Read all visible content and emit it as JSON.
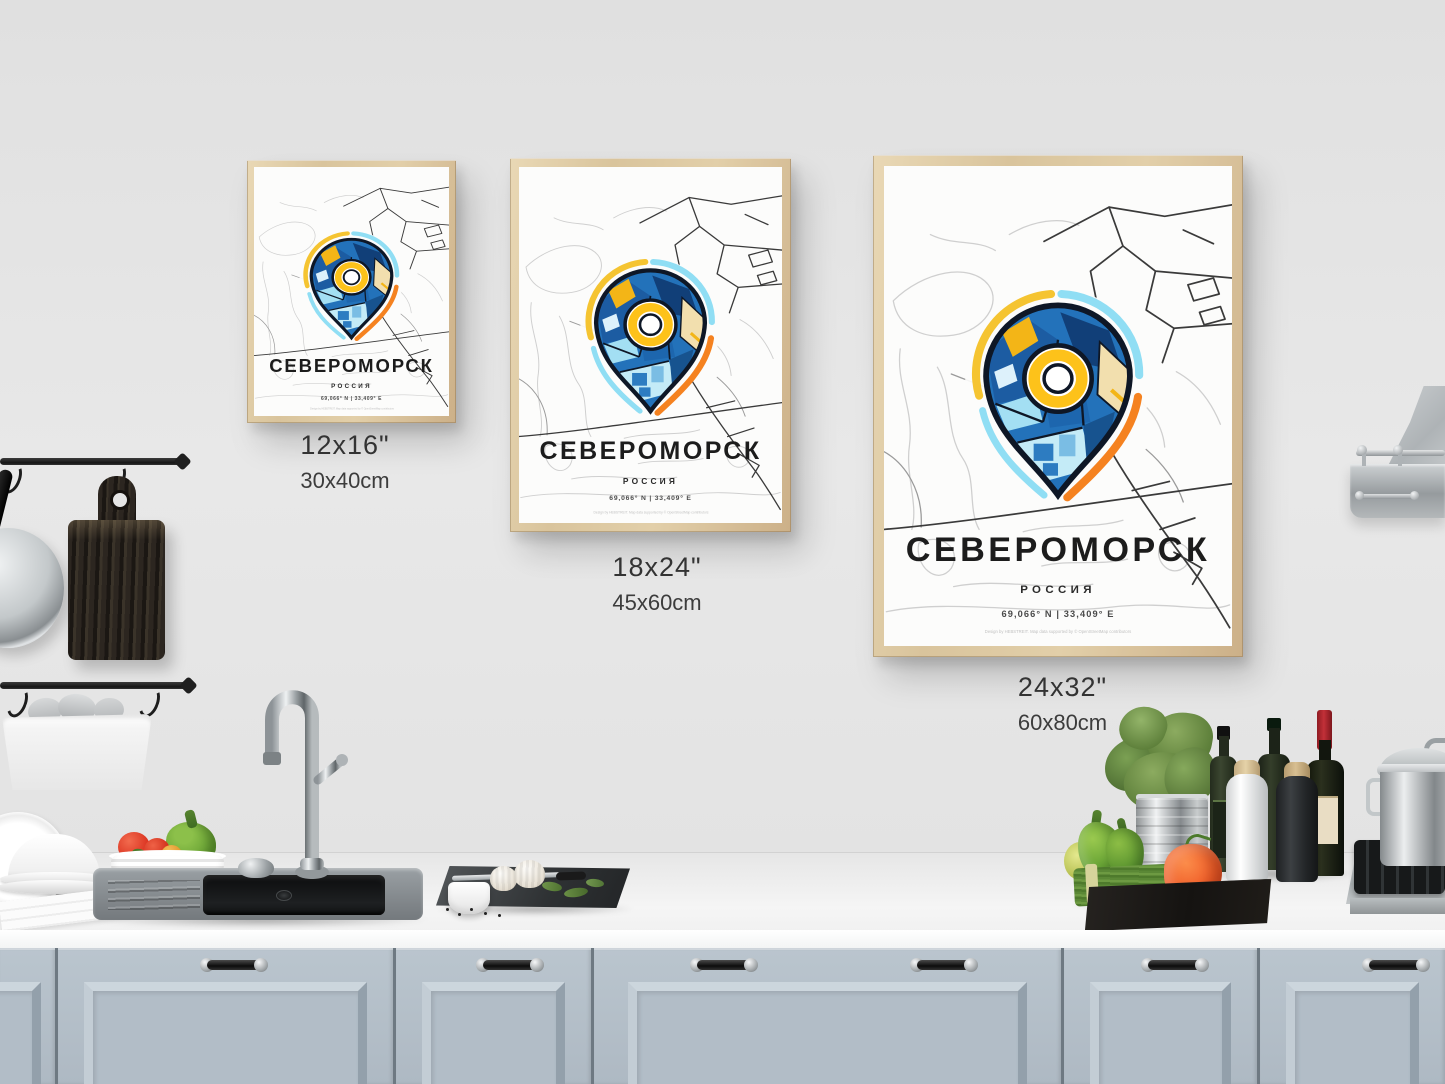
{
  "poster": {
    "title": "СЕВЕРОМОРСК",
    "subtitle": "РОССИЯ",
    "coordinates": "69,066° N | 33,409° E",
    "footer_note": "Design by HEBSTREIT. Map data supported by © OpenStreetMap contributors"
  },
  "size_labels": [
    {
      "inches": "12x16\"",
      "cm": "30x40cm"
    },
    {
      "inches": "18x24\"",
      "cm": "45x60cm"
    },
    {
      "inches": "24x32\"",
      "cm": "60x80cm"
    }
  ],
  "colors": {
    "pin_blue": "#2372ba",
    "pin_dark_blue": "#113f78",
    "pin_light_blue": "#a3dff3",
    "pin_cyan": "#58c4e8",
    "pin_yellow": "#f3b517",
    "pin_orange": "#f58220",
    "pin_cream": "#f2dfae",
    "frame_wood": "#dcc9a3",
    "cabinet_blue_gray": "#b5c0c9"
  }
}
